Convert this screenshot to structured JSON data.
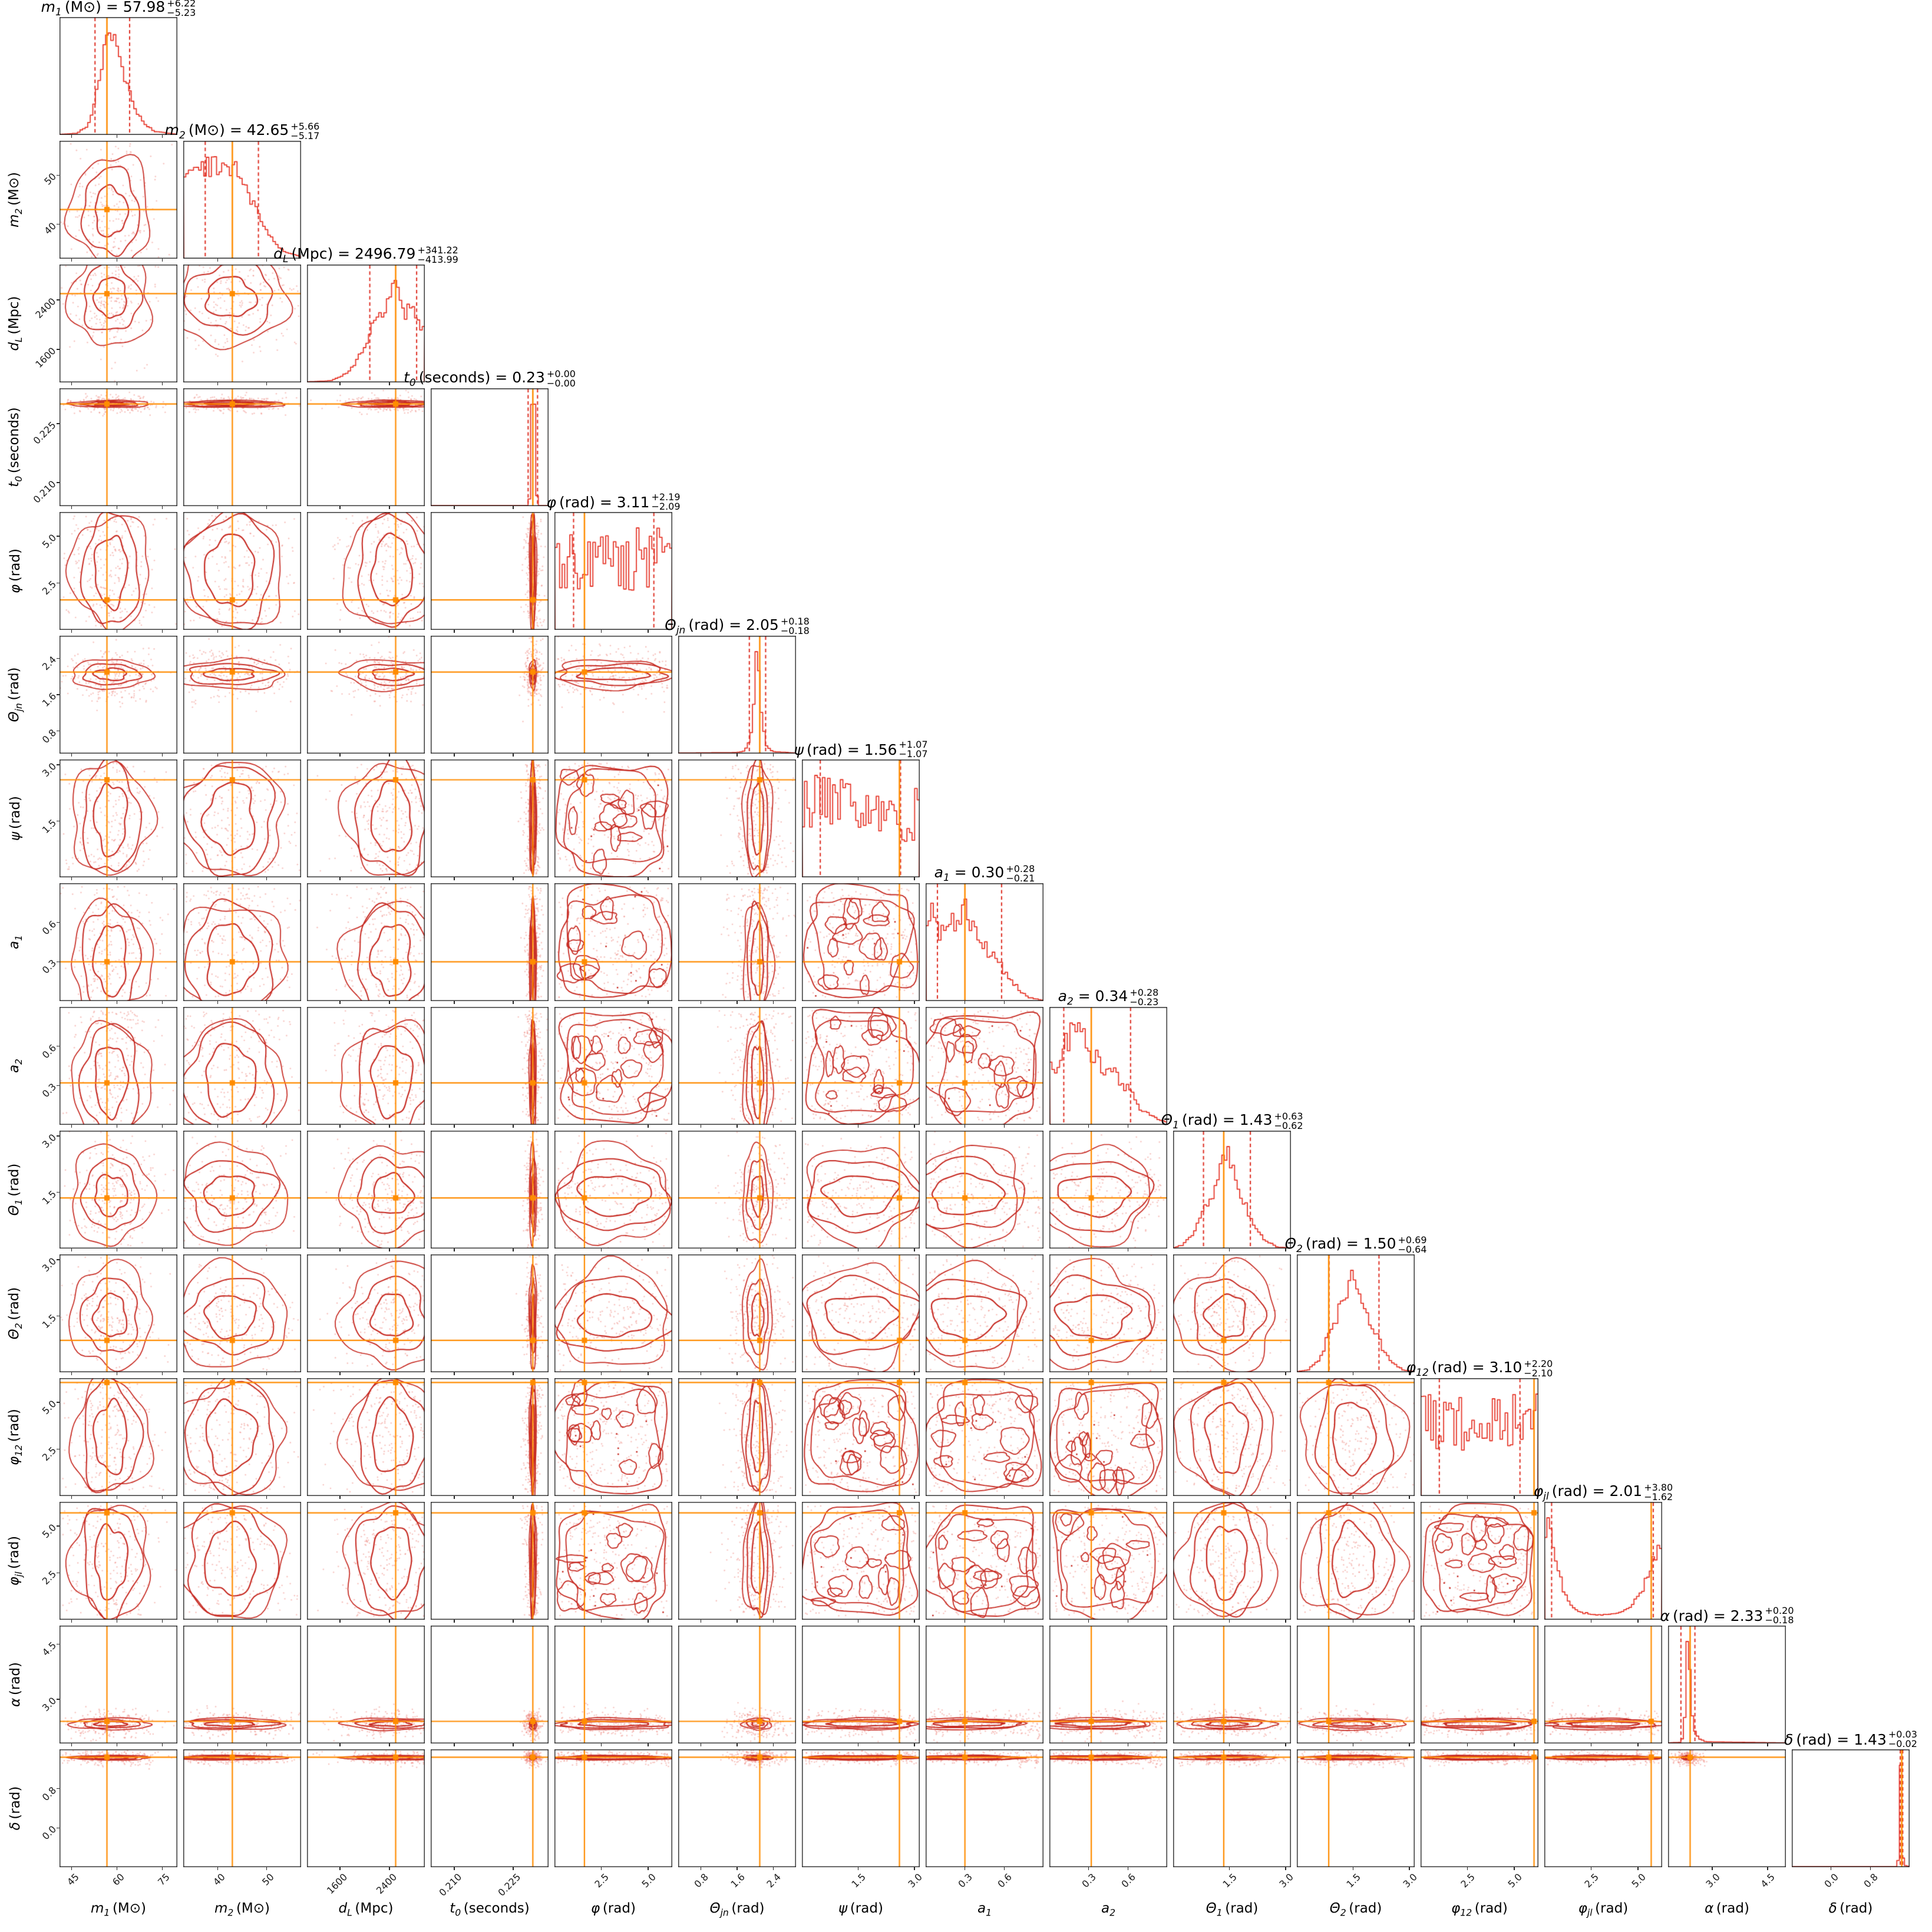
{
  "figure": {
    "kind": "corner-plot-posterior",
    "background": "#ffffff"
  },
  "colors": {
    "histogram": "#e6392c",
    "quantile_dash": "#dd2c20",
    "contour": "#c62a22",
    "scatter": "rgba(238,130,122,0.45)",
    "truth": "#ff8c00",
    "spine": "#262626",
    "text": "#1a1a1a"
  },
  "chart_data": {
    "type": "corner",
    "description": "15-parameter posterior corner plot: diagonal 1D marginal histograms with median/quantile titles, lower triangle 2D contours with scatter, orange injected-value crosshairs",
    "parameters": [
      {
        "id": "m1",
        "sym": "m",
        "sub": "1",
        "unit": "(M⊙)",
        "median_str": "57.98",
        "plus_str": "+6.22",
        "minus_str": "−5.23",
        "median": 57.98,
        "q16": 52.75,
        "q84": 64.2,
        "truth": 56.7,
        "range": [
          41,
          80
        ],
        "ticks": [
          45,
          60,
          75
        ],
        "tick_labels": [
          "45",
          "60",
          "75"
        ],
        "style": "blob",
        "center": 0.435,
        "spread": 0.13,
        "hist_noise": 0.12,
        "profile": [
          [
            0,
            0
          ],
          [
            0.15,
            0.01
          ],
          [
            0.24,
            0.08
          ],
          [
            0.3,
            0.3
          ],
          [
            0.36,
            0.62
          ],
          [
            0.41,
            0.95
          ],
          [
            0.44,
            1
          ],
          [
            0.5,
            0.8
          ],
          [
            0.56,
            0.5
          ],
          [
            0.63,
            0.28
          ],
          [
            0.7,
            0.12
          ],
          [
            0.8,
            0.03
          ],
          [
            1,
            0
          ]
        ]
      },
      {
        "id": "m2",
        "sym": "m",
        "sub": "2",
        "unit": "(M⊙)",
        "median_str": "42.65",
        "plus_str": "+5.66",
        "minus_str": "−5.17",
        "median": 42.65,
        "q16": 37.48,
        "q84": 48.31,
        "truth": 43.0,
        "range": [
          33,
          57
        ],
        "ticks": [
          40,
          50
        ],
        "tick_labels": [
          "40",
          "50"
        ],
        "style": "blob",
        "center": 0.4,
        "spread": 0.2,
        "hist_noise": 0.12,
        "profile": [
          [
            0,
            0.55
          ],
          [
            0.06,
            0.68
          ],
          [
            0.12,
            0.6
          ],
          [
            0.2,
            0.62
          ],
          [
            0.28,
            0.65
          ],
          [
            0.36,
            0.6
          ],
          [
            0.44,
            0.63
          ],
          [
            0.5,
            0.58
          ],
          [
            0.54,
            0.48
          ],
          [
            0.6,
            0.35
          ],
          [
            0.68,
            0.22
          ],
          [
            0.76,
            0.12
          ],
          [
            0.85,
            0.05
          ],
          [
            1,
            0.01
          ]
        ]
      },
      {
        "id": "dL",
        "sym": "d",
        "sub": "L",
        "unit": "(Mpc)",
        "median_str": "2496.79",
        "plus_str": "+341.22",
        "minus_str": "−413.99",
        "median": 2496.79,
        "q16": 2082.8,
        "q84": 2838.01,
        "truth": 2500,
        "range": [
          1070,
          2970
        ],
        "ticks": [
          1600,
          2400
        ],
        "tick_labels": [
          "1600",
          "2400"
        ],
        "style": "blob",
        "center": 0.72,
        "spread": 0.16,
        "hist_noise": 0.1,
        "profile": [
          [
            0,
            0
          ],
          [
            0.2,
            0.01
          ],
          [
            0.3,
            0.05
          ],
          [
            0.4,
            0.15
          ],
          [
            0.46,
            0.28
          ],
          [
            0.5,
            0.3
          ],
          [
            0.55,
            0.5
          ],
          [
            0.6,
            0.62
          ],
          [
            0.64,
            0.55
          ],
          [
            0.7,
            0.85
          ],
          [
            0.75,
            1
          ],
          [
            0.79,
            0.8
          ],
          [
            0.83,
            0.55
          ],
          [
            0.86,
            0.75
          ],
          [
            0.9,
            0.7
          ],
          [
            0.95,
            0.55
          ],
          [
            1,
            0.45
          ]
        ]
      },
      {
        "id": "t0",
        "sym": "t",
        "sub": "0",
        "unit": "(seconds)",
        "median_str": "0.23",
        "plus_str": "+0.00",
        "minus_str": "−0.00",
        "median": 0.23,
        "q16": 0.2288,
        "q84": 0.2312,
        "truth": 0.23,
        "range": [
          0.204,
          0.234
        ],
        "ticks": [
          0.21,
          0.225
        ],
        "tick_labels": [
          "0.210",
          "0.225"
        ],
        "style": "band",
        "center": 0.867,
        "spread": 0.012,
        "hist_noise": 0,
        "profile": [
          [
            0,
            0
          ],
          [
            0.83,
            0
          ],
          [
            0.85,
            0.1
          ],
          [
            0.862,
            0.7
          ],
          [
            0.872,
            1
          ],
          [
            0.882,
            0.45
          ],
          [
            0.895,
            0.1
          ],
          [
            0.91,
            0
          ],
          [
            1,
            0
          ]
        ]
      },
      {
        "id": "phi",
        "sym": "φ",
        "sub": "",
        "unit": "(rad)",
        "median_str": "3.11",
        "plus_str": "+2.19",
        "minus_str": "−2.09",
        "median": 3.11,
        "q16": 1.02,
        "q84": 5.3,
        "truth": 1.6,
        "range": [
          0,
          6.2832
        ],
        "ticks": [
          2.5,
          5.0
        ],
        "tick_labels": [
          "2.5",
          "5.0"
        ],
        "style": "flat",
        "center": 0.5,
        "spread": 0.3,
        "hist_noise": 0.45,
        "profile": [
          [
            0,
            0.55
          ],
          [
            1,
            0.55
          ]
        ]
      },
      {
        "id": "thetajn",
        "sym": "Θ",
        "sub": "jn",
        "unit": "(rad)",
        "median_str": "2.05",
        "plus_str": "+0.18",
        "minus_str": "−0.18",
        "median": 2.05,
        "q16": 1.87,
        "q84": 2.23,
        "truth": 2.1,
        "range": [
          0.3,
          2.9
        ],
        "ticks": [
          0.8,
          1.6,
          2.4
        ],
        "tick_labels": [
          "0.8",
          "1.6",
          "2.4"
        ],
        "style": "band",
        "center": 0.673,
        "spread": 0.05,
        "hist_noise": 0.1,
        "profile": [
          [
            0,
            0
          ],
          [
            0.5,
            0.005
          ],
          [
            0.56,
            0.02
          ],
          [
            0.6,
            0.1
          ],
          [
            0.63,
            0.3
          ],
          [
            0.65,
            0.7
          ],
          [
            0.665,
            1
          ],
          [
            0.68,
            0.9
          ],
          [
            0.7,
            0.55
          ],
          [
            0.72,
            0.25
          ],
          [
            0.75,
            0.08
          ],
          [
            0.8,
            0.015
          ],
          [
            1,
            0
          ]
        ]
      },
      {
        "id": "psi",
        "sym": "ψ",
        "sub": "",
        "unit": "(rad)",
        "median_str": "1.56",
        "plus_str": "+1.07",
        "minus_str": "−1.07",
        "median": 1.56,
        "q16": 0.49,
        "q84": 2.63,
        "truth": 2.6,
        "range": [
          0,
          3.1416
        ],
        "ticks": [
          1.5,
          3.0
        ],
        "tick_labels": [
          "1.5",
          "3.0"
        ],
        "style": "flat",
        "center": 0.5,
        "spread": 0.3,
        "hist_noise": 0.4,
        "profile": [
          [
            0,
            0.62
          ],
          [
            0.3,
            0.55
          ],
          [
            0.6,
            0.6
          ],
          [
            0.78,
            0.5
          ],
          [
            0.85,
            0.35
          ],
          [
            0.93,
            0.45
          ],
          [
            1,
            0.55
          ]
        ]
      },
      {
        "id": "a1",
        "sym": "a",
        "sub": "1",
        "unit": "",
        "median_str": "0.30",
        "plus_str": "+0.28",
        "minus_str": "−0.21",
        "median": 0.3,
        "q16": 0.09,
        "q84": 0.58,
        "truth": 0.3,
        "range": [
          0,
          0.9
        ],
        "ticks": [
          0.3,
          0.6
        ],
        "tick_labels": [
          "0.3",
          "0.6"
        ],
        "style": "flat",
        "center": 0.35,
        "spread": 0.27,
        "hist_noise": 0.15,
        "profile": [
          [
            0,
            0.72
          ],
          [
            0.06,
            0.9
          ],
          [
            0.12,
            0.72
          ],
          [
            0.2,
            0.78
          ],
          [
            0.3,
            0.82
          ],
          [
            0.34,
            1
          ],
          [
            0.4,
            0.72
          ],
          [
            0.48,
            0.58
          ],
          [
            0.56,
            0.45
          ],
          [
            0.64,
            0.35
          ],
          [
            0.72,
            0.22
          ],
          [
            0.8,
            0.1
          ],
          [
            0.88,
            0.03
          ],
          [
            1,
            0
          ]
        ]
      },
      {
        "id": "a2",
        "sym": "a",
        "sub": "2",
        "unit": "",
        "median_str": "0.34",
        "plus_str": "+0.28",
        "minus_str": "−0.23",
        "median": 0.34,
        "q16": 0.11,
        "q84": 0.62,
        "truth": 0.32,
        "range": [
          0,
          0.9
        ],
        "ticks": [
          0.3,
          0.6
        ],
        "tick_labels": [
          "0.3",
          "0.6"
        ],
        "style": "flat",
        "center": 0.38,
        "spread": 0.27,
        "hist_noise": 0.15,
        "profile": [
          [
            0,
            0.55
          ],
          [
            0.08,
            0.62
          ],
          [
            0.14,
            0.82
          ],
          [
            0.2,
            0.95
          ],
          [
            0.26,
            1
          ],
          [
            0.32,
            0.8
          ],
          [
            0.4,
            0.68
          ],
          [
            0.48,
            0.55
          ],
          [
            0.56,
            0.52
          ],
          [
            0.64,
            0.4
          ],
          [
            0.7,
            0.32
          ],
          [
            0.78,
            0.15
          ],
          [
            0.86,
            0.1
          ],
          [
            0.93,
            0.05
          ],
          [
            1,
            0.02
          ]
        ]
      },
      {
        "id": "theta1",
        "sym": "Θ",
        "sub": "1",
        "unit": "(rad)",
        "median_str": "1.43",
        "plus_str": "+0.63",
        "minus_str": "−0.62",
        "median": 1.43,
        "q16": 0.81,
        "q84": 2.06,
        "truth": 1.35,
        "range": [
          0,
          3.1416
        ],
        "ticks": [
          1.5,
          3.0
        ],
        "tick_labels": [
          "1.5",
          "3.0"
        ],
        "style": "blob",
        "center": 0.455,
        "spread": 0.16,
        "hist_noise": 0.15,
        "profile": [
          [
            0,
            0
          ],
          [
            0.08,
            0.03
          ],
          [
            0.16,
            0.12
          ],
          [
            0.24,
            0.3
          ],
          [
            0.32,
            0.5
          ],
          [
            0.4,
            0.8
          ],
          [
            0.45,
            1
          ],
          [
            0.5,
            0.78
          ],
          [
            0.56,
            0.6
          ],
          [
            0.62,
            0.42
          ],
          [
            0.7,
            0.22
          ],
          [
            0.78,
            0.08
          ],
          [
            0.88,
            0.01
          ],
          [
            1,
            0
          ]
        ]
      },
      {
        "id": "theta2",
        "sym": "Θ",
        "sub": "2",
        "unit": "(rad)",
        "median_str": "1.50",
        "plus_str": "+0.69",
        "minus_str": "−0.64",
        "median": 1.5,
        "q16": 0.86,
        "q84": 2.19,
        "truth": 0.85,
        "range": [
          0,
          3.1416
        ],
        "ticks": [
          1.5,
          3.0
        ],
        "tick_labels": [
          "1.5",
          "3.0"
        ],
        "style": "blob",
        "center": 0.477,
        "spread": 0.17,
        "hist_noise": 0.15,
        "profile": [
          [
            0,
            0
          ],
          [
            0.1,
            0.02
          ],
          [
            0.2,
            0.15
          ],
          [
            0.28,
            0.42
          ],
          [
            0.34,
            0.6
          ],
          [
            0.4,
            0.75
          ],
          [
            0.46,
            1
          ],
          [
            0.52,
            0.8
          ],
          [
            0.58,
            0.65
          ],
          [
            0.64,
            0.5
          ],
          [
            0.72,
            0.28
          ],
          [
            0.8,
            0.1
          ],
          [
            0.9,
            0.02
          ],
          [
            1,
            0
          ]
        ]
      },
      {
        "id": "phi12",
        "sym": "φ",
        "sub": "12",
        "unit": "(rad)",
        "median_str": "3.10",
        "plus_str": "+2.20",
        "minus_str": "−2.10",
        "median": 3.1,
        "q16": 1.0,
        "q84": 5.3,
        "truth": 6.05,
        "range": [
          0,
          6.2832
        ],
        "ticks": [
          2.5,
          5.0
        ],
        "tick_labels": [
          "2.5",
          "5.0"
        ],
        "style": "flat",
        "center": 0.5,
        "spread": 0.3,
        "hist_noise": 0.4,
        "profile": [
          [
            0,
            0.55
          ],
          [
            1,
            0.55
          ]
        ]
      },
      {
        "id": "phijl",
        "sym": "φ",
        "sub": "jl",
        "unit": "(rad)",
        "median_str": "2.01",
        "plus_str": "+3.80",
        "minus_str": "−1.62",
        "median": 2.01,
        "q16": 0.39,
        "q84": 5.81,
        "truth": 5.7,
        "range": [
          0,
          6.2832
        ],
        "ticks": [
          2.5,
          5.0
        ],
        "tick_labels": [
          "2.5",
          "5.0"
        ],
        "style": "flat",
        "center": 0.5,
        "spread": 0.32,
        "hist_noise": 0.12,
        "profile": [
          [
            0,
            0.6
          ],
          [
            0.03,
            0.95
          ],
          [
            0.05,
            1
          ],
          [
            0.08,
            0.75
          ],
          [
            0.12,
            0.5
          ],
          [
            0.16,
            0.28
          ],
          [
            0.22,
            0.14
          ],
          [
            0.3,
            0.07
          ],
          [
            0.45,
            0.04
          ],
          [
            0.6,
            0.05
          ],
          [
            0.7,
            0.09
          ],
          [
            0.8,
            0.22
          ],
          [
            0.88,
            0.42
          ],
          [
            0.94,
            0.62
          ],
          [
            0.97,
            0.75
          ],
          [
            1,
            0.6
          ]
        ]
      },
      {
        "id": "alpha",
        "sym": "α",
        "sub": "",
        "unit": "(rad)",
        "median_str": "2.33",
        "plus_str": "+0.20",
        "minus_str": "−0.18",
        "median": 2.33,
        "q16": 2.15,
        "q84": 2.53,
        "truth": 2.4,
        "range": [
          1.8,
          5.0
        ],
        "ticks": [
          3.0,
          4.5
        ],
        "tick_labels": [
          "3.0",
          "4.5"
        ],
        "style": "band",
        "center": 0.166,
        "spread": 0.02,
        "hist_noise": 0.05,
        "profile": [
          [
            0,
            0
          ],
          [
            0.1,
            0.005
          ],
          [
            0.13,
            0.05
          ],
          [
            0.15,
            0.35
          ],
          [
            0.165,
            1
          ],
          [
            0.18,
            0.8
          ],
          [
            0.2,
            0.3
          ],
          [
            0.22,
            0.12
          ],
          [
            0.26,
            0.04
          ],
          [
            0.32,
            0.01
          ],
          [
            1,
            0
          ]
        ]
      },
      {
        "id": "delta",
        "sym": "δ",
        "sub": "",
        "unit": "(rad)",
        "median_str": "1.43",
        "plus_str": "+0.03",
        "minus_str": "−0.02",
        "median": 1.43,
        "q16": 1.41,
        "q84": 1.46,
        "truth": 1.44,
        "range": [
          -0.8,
          1.6
        ],
        "ticks": [
          0.0,
          0.8
        ],
        "tick_labels": [
          "0.0",
          "0.8"
        ],
        "style": "band",
        "center": 0.929,
        "spread": 0.008,
        "hist_noise": 0,
        "profile": [
          [
            0,
            0
          ],
          [
            0.88,
            0
          ],
          [
            0.9,
            0.03
          ],
          [
            0.915,
            0.2
          ],
          [
            0.925,
            1
          ],
          [
            0.935,
            0.5
          ],
          [
            0.945,
            0.08
          ],
          [
            0.96,
            0.01
          ],
          [
            1,
            0
          ]
        ]
      }
    ]
  }
}
